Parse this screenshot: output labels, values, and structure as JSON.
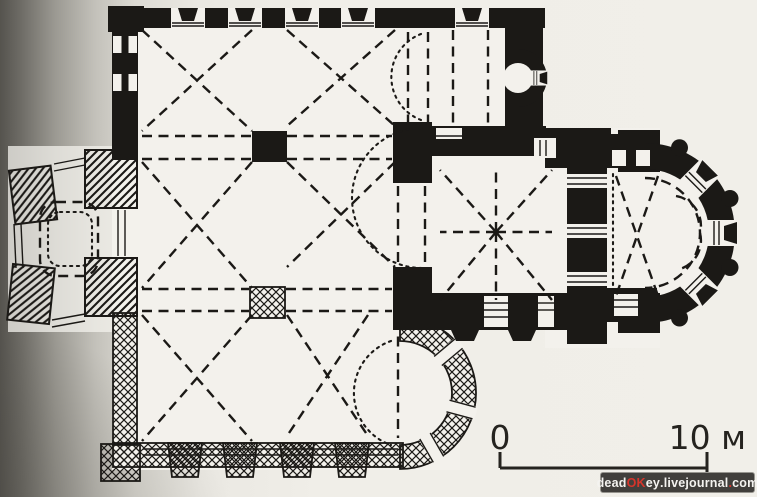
{
  "colors": {
    "ink": "#1b1916",
    "paperWhite": "#f3f1ec",
    "paperDark": "#55534e",
    "scaleText": "#25231f",
    "watermarkBg": "#413f3c",
    "watermarkBorder": "#97958f",
    "watermarkText": "#f4f3f0",
    "watermarkAccent": "#d6352b"
  },
  "scale_bar": {
    "start_label": "0",
    "end_label": "10 м"
  },
  "watermark": {
    "segments": [
      {
        "text": "dead"
      },
      {
        "text": "OK"
      },
      {
        "text": "ey"
      },
      {
        "text": "."
      },
      {
        "text": "livejournal"
      },
      {
        "text": "."
      },
      {
        "text": "com"
      }
    ]
  }
}
